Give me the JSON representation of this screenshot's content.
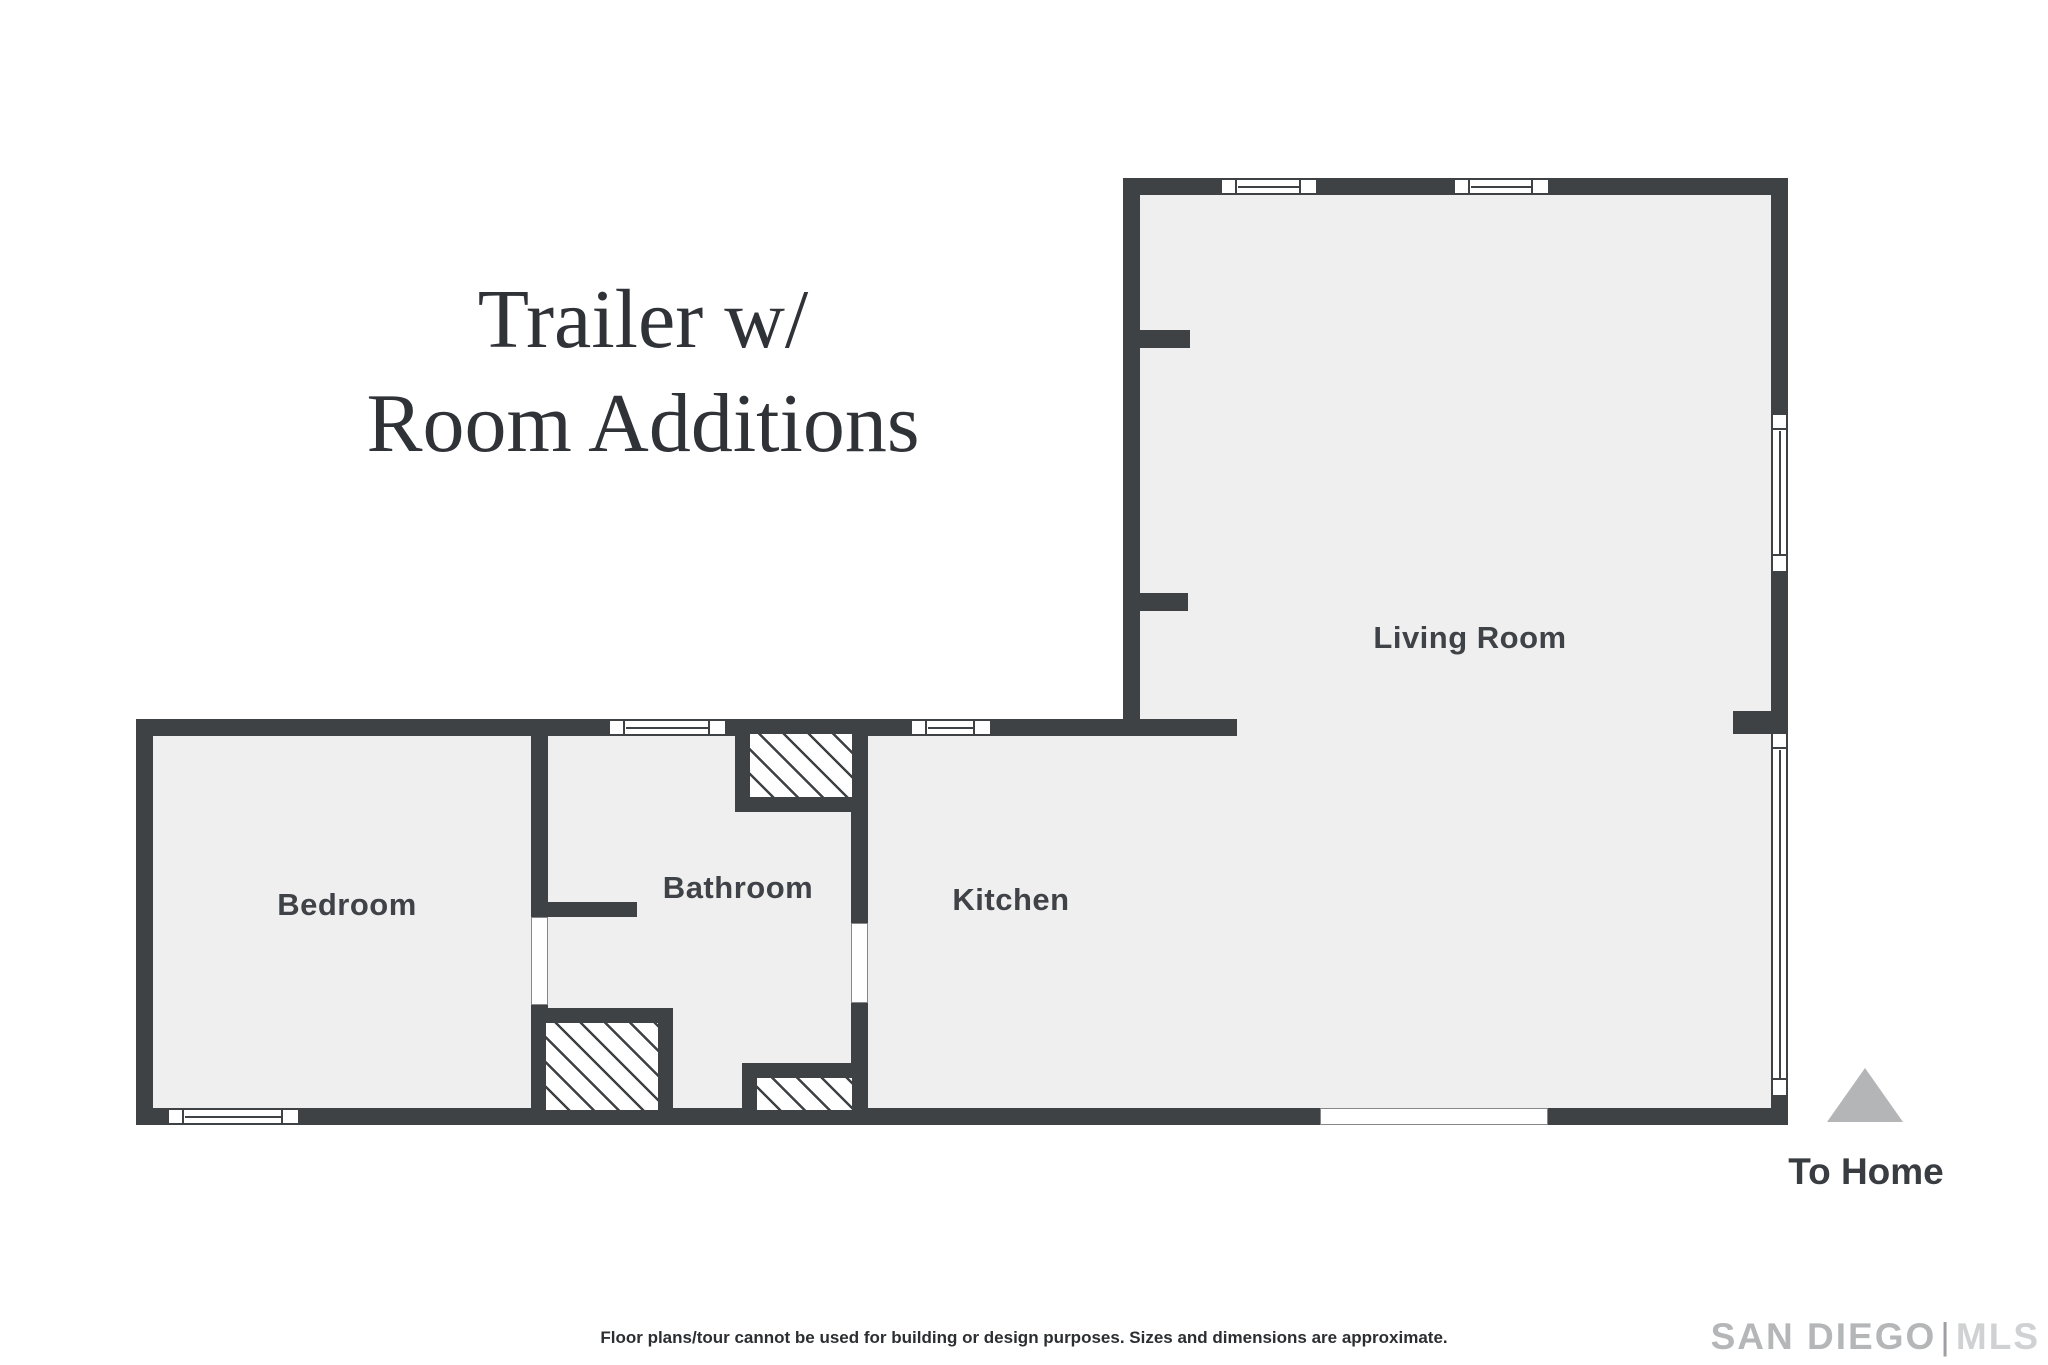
{
  "title": {
    "line1": "Trailer w/",
    "line2": "Room Additions"
  },
  "rooms": {
    "bedroom": "Bedroom",
    "bathroom": "Bathroom",
    "kitchen": "Kitchen",
    "living_room": "Living Room"
  },
  "annotations": {
    "to_home": "To Home"
  },
  "footer": {
    "disclaimer": "Floor plans/tour cannot be used for building or design purposes. Sizes and dimensions are approximate."
  },
  "logo": {
    "part1": "SAN DIEGO",
    "divider": "|",
    "part2": "MLS"
  },
  "colors": {
    "wall": "#3e4245",
    "floor": "#efeff0",
    "background": "#ffffff",
    "hatch_line": "#3e4245",
    "triangle": "#b3b5b7",
    "room_label": "#3f4347",
    "title_text": "#2f3337",
    "footer_text": "#2c2f32",
    "logo_gray": "#b4b6b8"
  }
}
